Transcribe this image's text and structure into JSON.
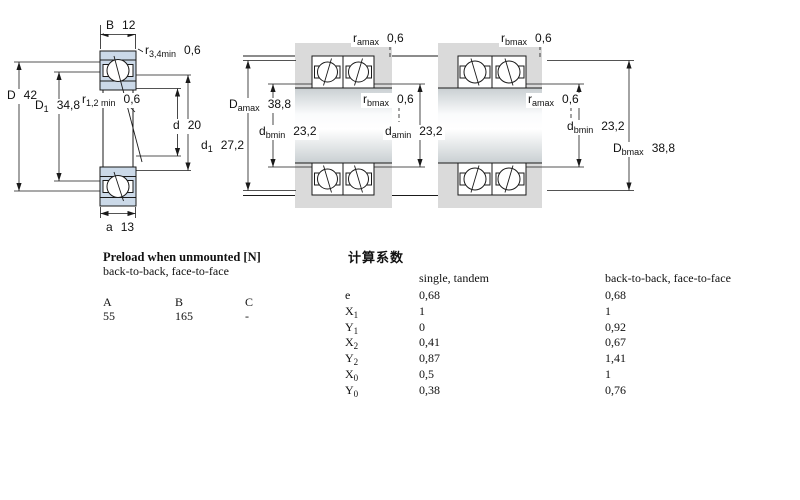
{
  "figures": {
    "left": {
      "B": {
        "sym": "B",
        "sub": "",
        "val": "12"
      },
      "r34": {
        "sym": "r",
        "sub": "3,4min",
        "val": "0,6"
      },
      "D": {
        "sym": "D",
        "sub": "",
        "val": "42"
      },
      "D1": {
        "sym": "D",
        "sub": "1",
        "val": "34,8"
      },
      "r12": {
        "sym": "r",
        "sub": "1,2 min",
        "val": "0,6"
      },
      "d": {
        "sym": "d",
        "sub": "",
        "val": "20"
      },
      "d1": {
        "sym": "d",
        "sub": "1",
        "val": "27,2"
      },
      "a": {
        "sym": "a",
        "sub": "",
        "val": "13"
      }
    },
    "middle": {
      "ramax": {
        "sym": "r",
        "sub": "amax",
        "val": "0,6"
      },
      "Damax": {
        "sym": "D",
        "sub": "amax",
        "val": "38,8"
      },
      "dbmin": {
        "sym": "d",
        "sub": "bmin",
        "val": "23,2"
      },
      "rbmax": {
        "sym": "r",
        "sub": "bmax",
        "val": "0,6"
      },
      "damin": {
        "sym": "d",
        "sub": "amin",
        "val": "23,2"
      }
    },
    "right": {
      "rbmax": {
        "sym": "r",
        "sub": "bmax",
        "val": "0,6"
      },
      "ramax": {
        "sym": "r",
        "sub": "amax",
        "val": "0,6"
      },
      "dbmin": {
        "sym": "d",
        "sub": "bmin",
        "val": "23,2"
      },
      "Dbmax": {
        "sym": "D",
        "sub": "bmax",
        "val": "38,8"
      }
    }
  },
  "preload": {
    "title": "Preload when unmounted [N]",
    "subtitle": "back-to-back, face-to-face",
    "columns": [
      "A",
      "B",
      "C"
    ],
    "values": [
      "55",
      "165",
      "-"
    ]
  },
  "factors": {
    "title": "计算系数",
    "col_single_header": "single, tandem",
    "col_paired_header": "back-to-back, face-to-face",
    "rows": [
      {
        "sym": "e",
        "sub": "",
        "single": "0,68",
        "paired": "0,68"
      },
      {
        "sym": "X",
        "sub": "1",
        "single": "1",
        "paired": "1"
      },
      {
        "sym": "Y",
        "sub": "1",
        "single": "0",
        "paired": "0,92"
      },
      {
        "sym": "X",
        "sub": "2",
        "single": "0,41",
        "paired": "0,67"
      },
      {
        "sym": "Y",
        "sub": "2",
        "single": "0,87",
        "paired": "1,41"
      },
      {
        "sym": "X",
        "sub": "0",
        "single": "0,5",
        "paired": "1"
      },
      {
        "sym": "Y",
        "sub": "0",
        "single": "0,38",
        "paired": "0,76"
      }
    ]
  },
  "colors": {
    "ring_blue": "#cbd9e8",
    "housing_gray": "#dadada",
    "line": "#1a1a1a",
    "background": "#ffffff"
  }
}
